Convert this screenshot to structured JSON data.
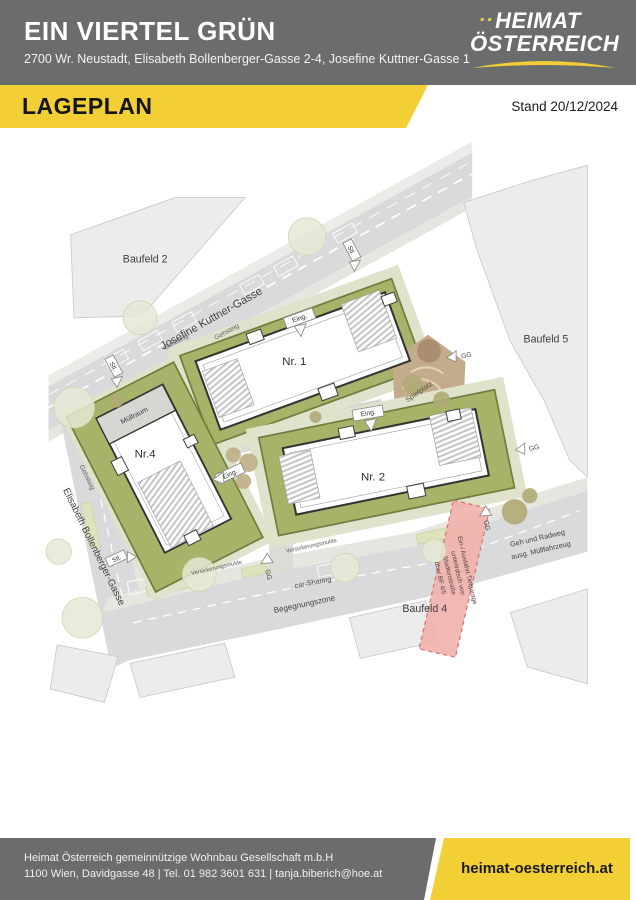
{
  "header": {
    "title": "EIN VIERTEL GRÜN",
    "address": "2700 Wr. Neustadt, Elisabeth Bollenberger-Gasse 2-4, Josefine Kuttner-Gasse 1"
  },
  "logo": {
    "dots": "..",
    "line1": "HEIMAT",
    "line2": "ÖSTERREICH"
  },
  "banner": {
    "title": "LAGEPLAN",
    "stand": "Stand 20/12/2024"
  },
  "plan": {
    "labels": {
      "baufeld2": "Baufeld 2",
      "baufeld5": "Baufeld 5",
      "baufeld4": "Baufeld 4",
      "street_josefine": "Josefine Kuttner-Gasse",
      "street_elisabeth": "Elisabeth Bollenberger-Gasse",
      "nr1": "Nr. 1",
      "nr2": "Nr. 2",
      "nr4": "Nr.4",
      "muellraum": "Müllraum",
      "spielplatz": "Spielplatz",
      "gehsteig": "Gehsteig",
      "stl": "Stl.",
      "gg": "GG",
      "eing": "Eing.",
      "versickerungsmulde": "Versickerungsmulde",
      "car_sharing": "car-Sharing",
      "begegnungszone": "Begegnungszone",
      "geh_radweg_1": "Geh und Radweg",
      "geh_radweg_2": "ausg. Müllfahrzeug",
      "tg_line1": "Ein-/ Ausfahrt Tiefgarage",
      "tg_line2": "unterirdisch von",
      "tg_line3": "Stadionstraße",
      "tg_line4": "über BF 4/5"
    }
  },
  "footer": {
    "line1": "Heimat Österreich gemeinnützige Wohnbau Gesellschaft m.b.H",
    "line2": "1100 Wien, Davidgasse 48 | Tel. 01 982 3601 631 | tanja.biberich@hoe.at",
    "website": "heimat-oesterreich.at"
  },
  "colors": {
    "accent_yellow": "#F2CF35",
    "header_gray": "#6B6C6E",
    "map_olive_green": "#A7B369",
    "map_pale_green": "#DFE3CB",
    "map_street_gray": "#D9DADB",
    "map_playground_tan": "#C3AB8B",
    "map_red_zone": "#F1B0AC"
  }
}
